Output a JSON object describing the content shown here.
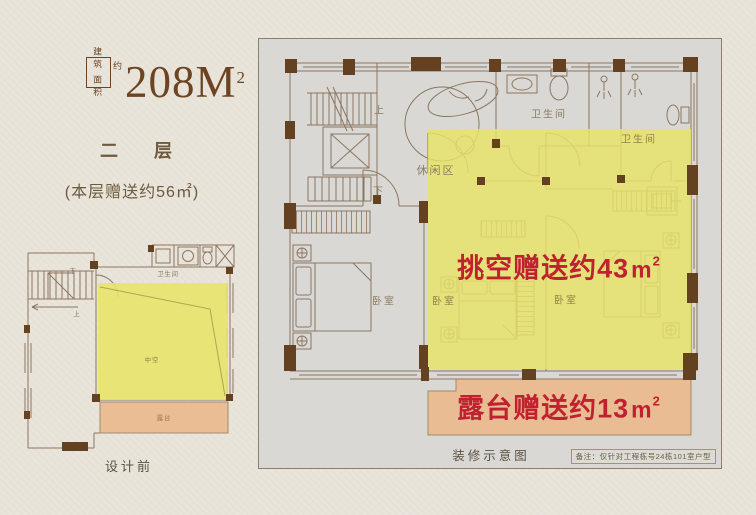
{
  "colors": {
    "page_bg": "#e9e4da",
    "plan_bg": "#d9d8d4",
    "wall_line": "#8c7661",
    "wall_pier_fill": "#644120",
    "highlight_yellow": "#e8e468",
    "highlight_orange": "#eaba8e",
    "accent_red": "#c1212f",
    "text_brown": "#6e5a3d",
    "logo_brown": "#6d4423"
  },
  "logo": {
    "box_row1": "建筑",
    "box_row2": "面积",
    "approx": "约",
    "area": "208M",
    "area_sup": "2"
  },
  "left_panel": {
    "floor_title": "二　层",
    "gift_note": "(本层赠送约56㎡)",
    "caption": "设计前"
  },
  "small_plan": {
    "labels": {
      "down": "下",
      "up": "上",
      "bathroom": "卫生间",
      "void": "中空",
      "terrace": "露台"
    }
  },
  "main_plan": {
    "labels": {
      "up": "上",
      "down": "下",
      "leisure": "休闲区",
      "bathroom_top": "卫生间",
      "bathroom_right": "卫生间",
      "bedroom_left": "卧室",
      "bedroom_mid": "卧室",
      "bedroom_right": "卧室"
    },
    "void_gift": {
      "text": "挑空赠送约43",
      "unit": "m",
      "sup": "2"
    },
    "terrace_gift": {
      "text": "露台赠送约13",
      "unit": "m",
      "sup": "2"
    },
    "caption": "装修示意图",
    "note": "备注：仅针对工程栋号24栋101室户型"
  }
}
